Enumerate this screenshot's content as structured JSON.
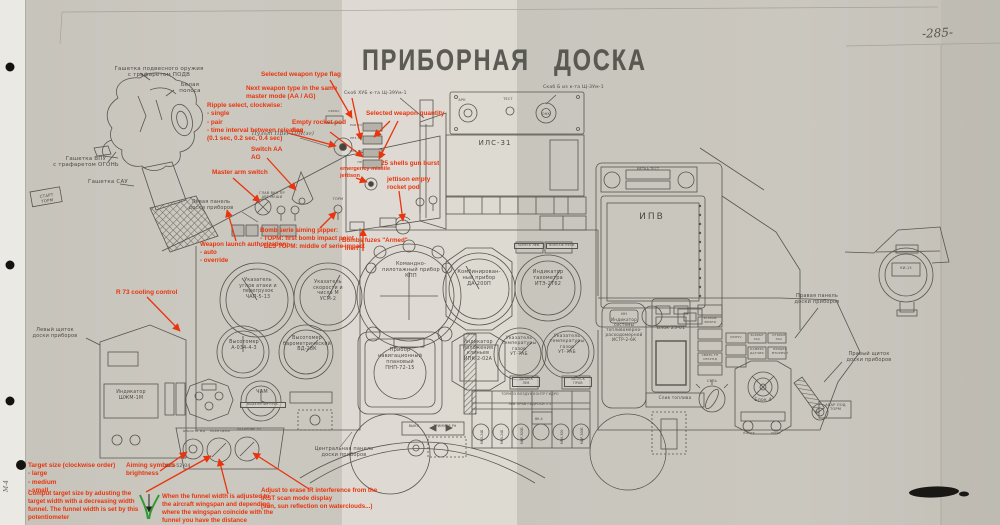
{
  "page": {
    "title": "ПРИБОРНАЯ ДОСКА",
    "number": "-285-",
    "margin_note": "М-4",
    "accent_red": "#e8350e",
    "accent_green": "#2e9b33"
  },
  "annotations": {
    "weapon_type_flag": "Selected weapon type flag",
    "next_weapon_type": "Next weapon type in the same\nmaster mode (AA / AG)",
    "ripple_select": "Ripple select, clockwise:\n- single\n- pair\n- time interval between releases\n(0.1 sec, 0.2 sec, 0.4 sec)",
    "empty_rocket_pod": "Empty rocket pod\nflag",
    "weapon_quantity": "Selected weapon quantity",
    "switch_aa_ag": "Switch AA\nAG",
    "master_arm": "Master arm switch",
    "emergency_jettison": "emergency missile\njettison",
    "gun_burst": "25 shells gun burst",
    "jettison_pod": "jettison empty\nrocket pod",
    "bomb_serie": "Bomb serie aiming pipper:\n- ТОРМ: first bomb impact point\n- БЕЗ ТОРМ: middle of serie impact",
    "bombs_fuzes": "Bombs fuzes \"Armed\"\n\"Inert\"",
    "launch_auth": "Weapon launch authorization:\n- auto\n- override",
    "r73_cooling": "R 73 cooling control",
    "target_size": "Target size (clockwise order)\n- large\n- medium\n- small",
    "comput_target": "Comput target size by adusting the\ntarget width with a decreasing width\nfunnel. The funnel width is set by this\npotentiometer",
    "aiming_brightness": "Aiming symbols\nbrightness",
    "funnel_width": "When the funnel width is adjusted to\nthe aircraft wingspan and depending\nwhere the wingspan coincide with the\nfunnel you have the distance",
    "ir_adjust": "Adjust to erase IR interference from the\nIRST scan mode display\n(sun, sun reflection on waterclouds...)"
  },
  "labels": {
    "stick_weapon_trigger": "Гашетка подвесного оружия\nс трафаретом ПОДВ",
    "stick_white_stripe": "Белая\nполоса",
    "stick_gun_trigger": "Гашетка ВПУ\nс трафаретом ОГОНЬ",
    "stick_sau": "Гашетка САУ",
    "stick_tag": "СТАРТ\nТОРМ",
    "left_shield": "Левый щиток\nдоски приборов",
    "left_panel": "Левая панель\nдоски приборов",
    "pvi": "Пульт ПВИ-10П(зг)",
    "hud": "ИЛС-31",
    "hud_kit_left": "Скоб ХУБ к-та Щ-39Ум-1",
    "hud_kit_right": "Скаб Б из к-та Щ-3Ум-1",
    "ark": "АРК",
    "test": "ТЕСТ",
    "onk": "ОНК",
    "sbros": "СБРОС",
    "win1": "РАБ ЗЧ",
    "win2": "РЕЗ ЗЧ",
    "win3": "ОСТ ЗЧ",
    "win4": "НР",
    "glav_vkl": "ГЛАВ ВКЛ   ПР\nАВТ   МЕШИ",
    "torm": "ТОРМ",
    "kpp": "Командно-\nпилотажный прибор\nКПП",
    "da200": "Комбинирован-\nный прибор\nДА-200П",
    "tach": "Индикатор\nтахометра\nИТЭ-2Т62",
    "aoa": "Указатель\nуглов атаки и\nперегрузок\nЧАП-5-13",
    "usm": "Указатель\nскорости и\nчисла М\nУСМ-2",
    "alt1": "Высотомер\nА-034-4-3",
    "alt2": "Высотомер\nбарометрический\nВД-28К",
    "pnp": "Прибор\nнавигационный\nплановый\nПНП-72-15",
    "ipk": "Индикатор\nположения\nклиньев\nИПК-2-02А",
    "ut1": "Указатель\nтемпературы\nгазов\nУТ-7АБ",
    "ut2": "Указатель\nтемпературы\nгазов\nУТ-7АБ",
    "zapusk_lev": "ЗАПУСК\nЛЕВ",
    "zapusk_prav": "ЗАПУСК\nПРАВ",
    "forsazh_lev": "ЗАПУСК ЛЕВ.",
    "forsazh_prav": "ФОРСАЖ ПРАВ.",
    "table_row1": "ТОРМОЗ    ВОЗДУХ   КОНТР     ГИДРО",
    "table_row2": "ЛЕВ  ПРАВ      ГИДРОСИ      1    2",
    "gauge_tags": [
      "МВ0-24Б",
      "МВ0-24Б",
      "МДР-300Б",
      "ВК-4",
      "МП0-300",
      "МДР-300Б"
    ],
    "vykl": "ВЫКЛ",
    "trimmer": "ТРИММЕР РН",
    "ipv": "ИПВ",
    "metka_test": "МЕТКА    ТЕСТ",
    "in_btn": "ИН",
    "istr": "Индикатор\nсистемы\nтопливомерно-\nрасходомерной\nИСТР-2-6К",
    "blok23": "Блок 23-01",
    "blok4": "Блок 4",
    "fuel_drain": "Слив топлива",
    "set": "СЕТЬ",
    "izluch": "ИЗЛУЧ",
    "zaprav": "ЗАПРАВ\nЗЕМЛЯ",
    "svyaz_tp": "СВЯЗЬ ТП\nСЕКУНД",
    "zakryt": "ЗАКРЫТ\nЗАС",
    "otkryt": "ОТКРЫТ\nЗАС",
    "kamera": "КАМЕРА\nДАТЧИК",
    "pricel": "ПРИЦЕЛ\nВТОРИЧН",
    "kontr": "КОНТР",
    "noch": "НОЧЬ",
    "right_panel": "Правая панель\nдоски приборов",
    "right_shield": "Правый щиток\nдоски приборов",
    "central_panel": "Центральная панель\nдоски приборов",
    "avar_tag": "АВАР ПОД\nТОРМ",
    "shzm": "Индикатор\nШЖМ-1М",
    "clock": "ЧАМ",
    "clock_sub": "ВЫДЕЛЕНИЕ ГРУБ.",
    "sho": "ШО-52-04",
    "knob_bright": "ЯРКОСТЬ МЦ",
    "knob_size": "РАЗМ ЦЕЛИ",
    "knob_dist": "УДАЛЕНИЕ ТП",
    "ki13": "КИ-13"
  }
}
